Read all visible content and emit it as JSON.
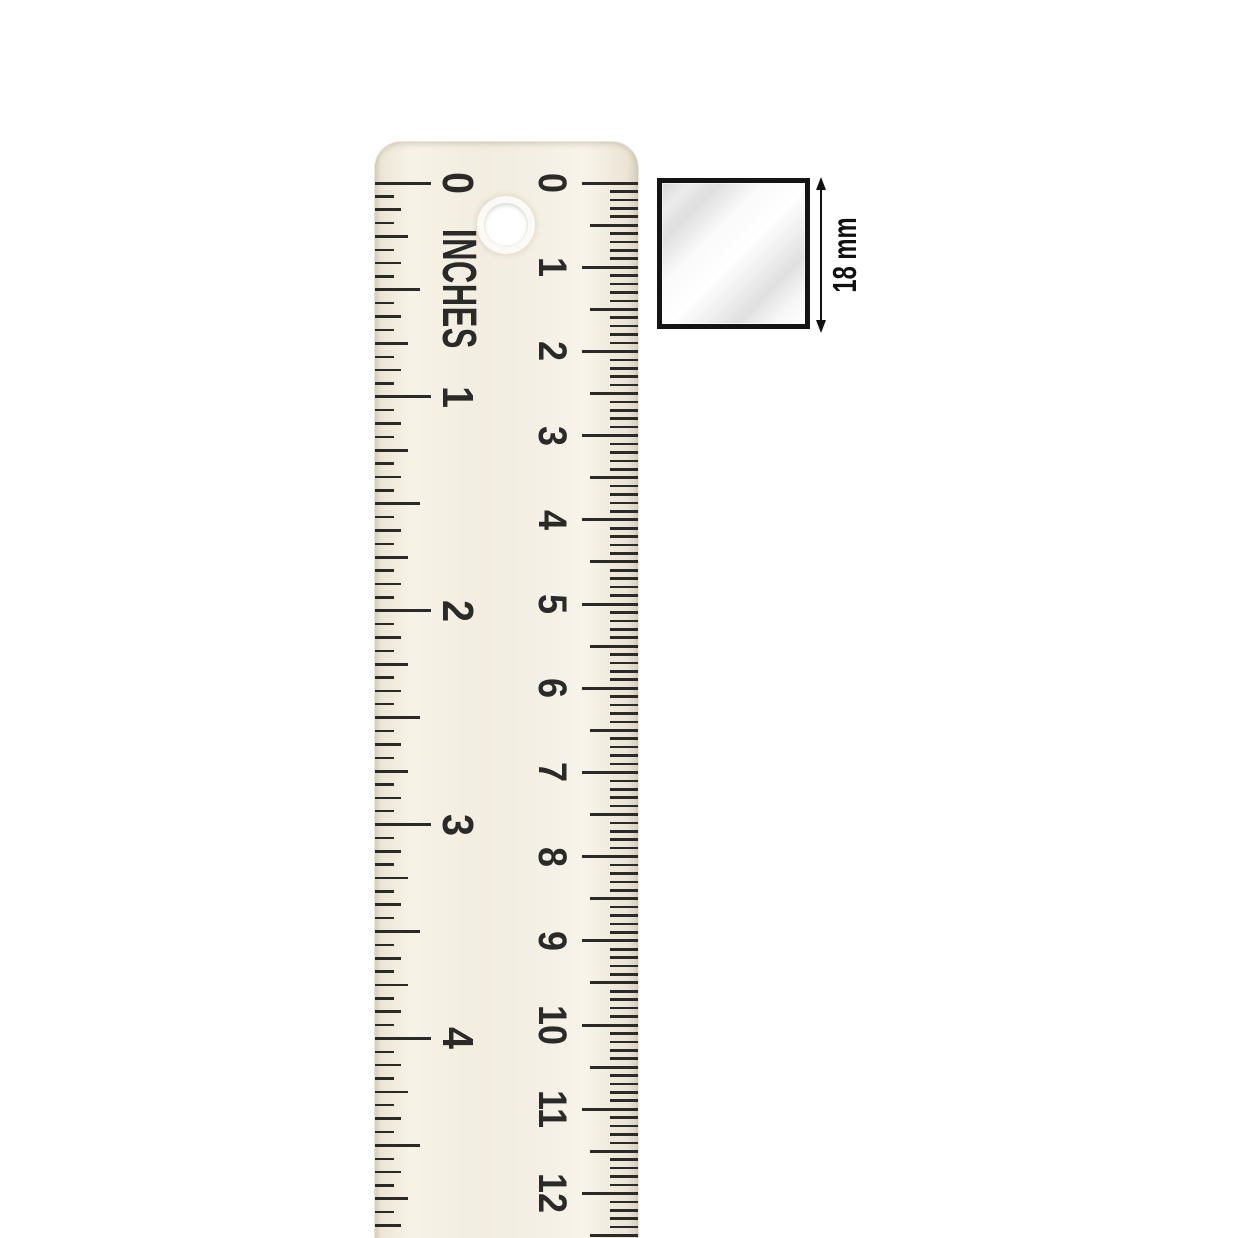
{
  "scene": {
    "background": "#ffffff"
  },
  "ruler": {
    "unit_label": "INCHES",
    "body_color": "#f3eee2",
    "edge_shade_color": "#d9d2c0",
    "tick_color": "#2a2a28",
    "text_color": "#2a2a28",
    "inches": {
      "labels": [
        "0",
        "1",
        "2",
        "3",
        "4"
      ]
    },
    "centimeters": {
      "labels": [
        "0",
        "1",
        "2",
        "3",
        "4",
        "5",
        "6",
        "7",
        "8",
        "9",
        "10",
        "11",
        "12"
      ]
    }
  },
  "specimen": {
    "description": "square metal profile",
    "border_color": "#141414",
    "sheen_base_color": "#d7d7d7",
    "sheen_highlight_color": "#ffffff"
  },
  "dimension": {
    "label": "18 mm",
    "arrow_color": "#111111"
  }
}
